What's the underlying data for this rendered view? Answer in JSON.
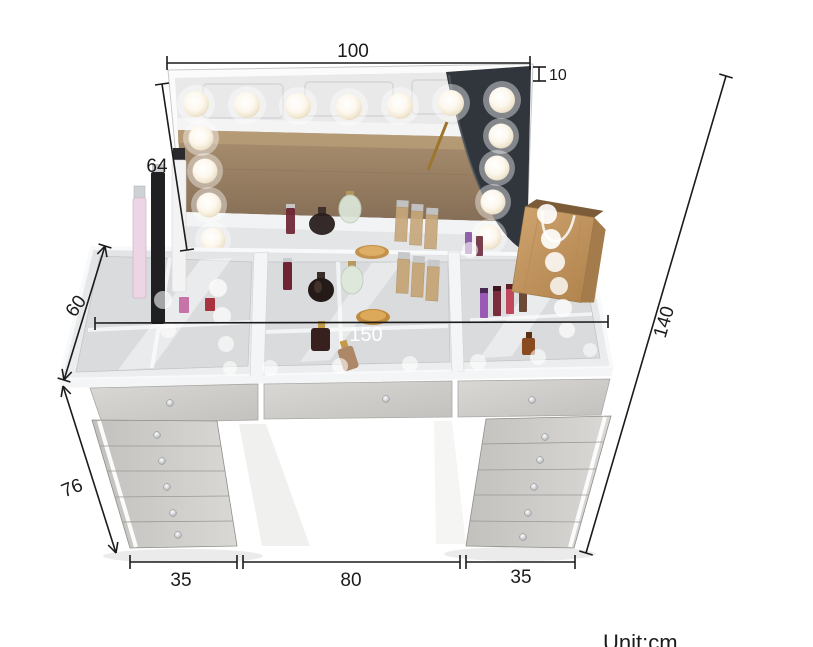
{
  "unit_label": "Unit:cm",
  "dimensions": {
    "mirror_width": "100",
    "mirror_frame_depth": "10",
    "mirror_height": "64",
    "table_depth": "60",
    "table_width": "150",
    "overall_height": "140",
    "pedestal_height": "76",
    "left_pedestal_width": "35",
    "kneehole_width": "80",
    "right_pedestal_width": "35"
  },
  "colors": {
    "dimension_line": "#1b1b1b",
    "table_width_label": "#ffffff",
    "mirror_frame": "#fbfbfb",
    "wood_reflection": "#9a8165",
    "chair_reflection": "#31363c",
    "bulb_warm_white": "#f7efdd",
    "drawer_front": "#cfcdca",
    "kraft_bag": "#c59a66"
  }
}
